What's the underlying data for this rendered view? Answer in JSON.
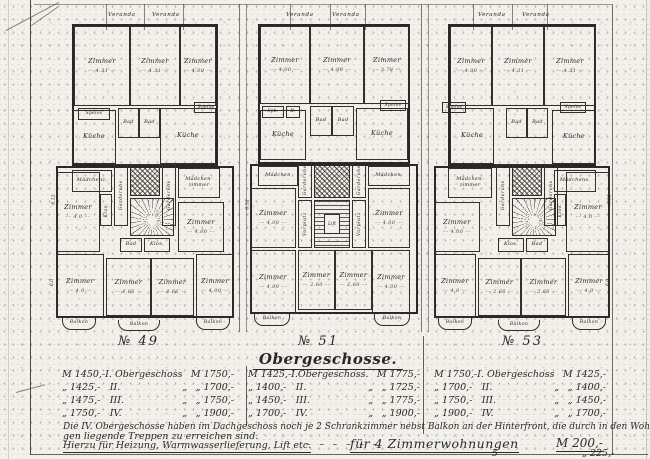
{
  "sheet": {
    "paper_color": "#f1f0ea",
    "ink_color": "#2b2925"
  },
  "title_block": {
    "heading": "Obergeschosse.",
    "price_tables": [
      {
        "building": "№ 49",
        "rows": [
          [
            "M 1450,-",
            "I. Obergeschoss",
            "",
            "M 1750,-"
          ],
          [
            "„ 1425,-",
            "II.",
            "„",
            "„ 1700,-"
          ],
          [
            "„ 1475,-",
            "III.",
            "„",
            "„ 1750,-"
          ],
          [
            "„ 1750,-",
            "IV.",
            "„",
            "„ 1900,-"
          ]
        ]
      },
      {
        "building": "№ 51",
        "rows": [
          [
            "M 1425,-",
            "I.Obergeschoss.",
            "",
            "M 1775,-"
          ],
          [
            "„ 1400,-",
            "II.",
            "„",
            "„ 1725,-"
          ],
          [
            "„ 1450,-",
            "III.",
            "„",
            "„ 1775,-"
          ],
          [
            "„ 1700,-",
            "IV.",
            "„",
            "„ 1900,-"
          ]
        ]
      },
      {
        "building": "№ 53",
        "rows": [
          [
            "M 1750,-",
            "I. Obergeschoss",
            "",
            "M 1425,-"
          ],
          [
            "„ 1700,-",
            "II.",
            "„",
            "„ 1400,-"
          ],
          [
            "„ 1750,-",
            "III.",
            "„",
            "„ 1450,-"
          ],
          [
            "„ 1900,-",
            "IV.",
            "„",
            "„ 1700,-"
          ]
        ]
      }
    ],
    "footnote_line1": "Die IV. Obergeschosse haben im Dachgeschoss noch je 2 Schrankzimmer nebst Balkon an der Hinterfront, die durch in den Wohnun=",
    "footnote_line2": "gen liegende Treppen zu erreichen sind.",
    "services_line": "Hierzu für Heizung, Warmwasserlieferung, Lift etc.",
    "services_dashes": "– – – – – –",
    "services_for4": "für 4 Zimmerwohnungen",
    "services_price4": "M 200,-",
    "services_for5": "5",
    "services_price5": "„ 225,-"
  },
  "buildings": [
    {
      "number": "№ 49",
      "x": 56,
      "y": 12,
      "w": 178,
      "h": 322,
      "num_x": 118,
      "num_y": 334,
      "veranda": [
        {
          "x": 52,
          "label": "Veranda"
        },
        {
          "x": 96,
          "label": "Veranda"
        }
      ],
      "blocks": [
        {
          "x": 16,
          "y": 12,
          "w": 146,
          "h": 142
        },
        {
          "x": 0,
          "y": 154,
          "w": 178,
          "h": 152
        }
      ],
      "rooms": [
        {
          "x": 18,
          "y": 14,
          "w": 56,
          "h": 80,
          "label": "Zimmer",
          "dim": "4.31"
        },
        {
          "x": 74,
          "y": 14,
          "w": 50,
          "h": 80,
          "label": "Zimmer",
          "dim": "4.31"
        },
        {
          "x": 124,
          "y": 14,
          "w": 36,
          "h": 80,
          "label": "Zimmer",
          "dim": "4.00"
        },
        {
          "x": 22,
          "y": 96,
          "w": 32,
          "h": 12,
          "label": "Speise",
          "fs": 4.5
        },
        {
          "x": 16,
          "y": 98,
          "w": 44,
          "h": 54,
          "label": "Küche"
        },
        {
          "x": 62,
          "y": 96,
          "w": 21,
          "h": 30,
          "label": "Bad",
          "fs": 5
        },
        {
          "x": 83,
          "y": 96,
          "w": 21,
          "h": 30,
          "label": "Bad",
          "fs": 5
        },
        {
          "x": 104,
          "y": 96,
          "w": 56,
          "h": 56,
          "label": "Küche"
        },
        {
          "x": 138,
          "y": 90,
          "w": 24,
          "h": 11,
          "label": "Speise",
          "fs": 4.5
        },
        {
          "x": 16,
          "y": 158,
          "w": 40,
          "h": 22,
          "label": "Mädchenz.",
          "fs": 5
        },
        {
          "x": 122,
          "y": 156,
          "w": 42,
          "h": 30,
          "label": "Mädchen-",
          "label2": "zimmer",
          "fs": 5
        },
        {
          "x": 0,
          "y": 160,
          "w": 44,
          "h": 80,
          "label": "Zimmer",
          "dim": "4.0"
        },
        {
          "x": 122,
          "y": 190,
          "w": 46,
          "h": 50,
          "label": "Zimmer",
          "dim": "4.00"
        },
        {
          "x": 64,
          "y": 226,
          "w": 22,
          "h": 14,
          "label": "Bad",
          "fs": 5
        },
        {
          "x": 88,
          "y": 226,
          "w": 26,
          "h": 14,
          "label": "Klos.",
          "fs": 5
        },
        {
          "x": 0,
          "y": 242,
          "w": 48,
          "h": 64,
          "label": "Zimmer",
          "dim": "4.0"
        },
        {
          "x": 50,
          "y": 246,
          "w": 45,
          "h": 58,
          "label": "Zimmer",
          "dim": "4.66"
        },
        {
          "x": 95,
          "y": 246,
          "w": 43,
          "h": 58,
          "label": "Zimmer",
          "dim": "4.66"
        },
        {
          "x": 140,
          "y": 242,
          "w": 38,
          "h": 64,
          "label": "Zimmer",
          "dim": "4.00"
        }
      ],
      "vrooms": [
        {
          "x": 58,
          "y": 152,
          "w": 14,
          "h": 62,
          "label": "Garderobe"
        },
        {
          "x": 106,
          "y": 152,
          "w": 14,
          "h": 62,
          "label": "Garderobe"
        },
        {
          "x": 44,
          "y": 182,
          "w": 12,
          "h": 32,
          "label": "Klos."
        }
      ],
      "shaft": {
        "x": 74,
        "y": 152,
        "w": 30,
        "h": 32
      },
      "stair": {
        "type": "spiral",
        "x": 74,
        "y": 186,
        "w": 44,
        "h": 38
      },
      "balconies": [
        {
          "x": 6,
          "y": 306,
          "w": 34,
          "h": 12,
          "label": "Balkon"
        },
        {
          "x": 62,
          "y": 308,
          "w": 42,
          "h": 11,
          "label": "Balkon"
        },
        {
          "x": 140,
          "y": 306,
          "w": 34,
          "h": 12,
          "label": "Balkon"
        }
      ],
      "sidedims": [
        {
          "x": -7,
          "y": 185,
          "label": "6.12"
        },
        {
          "x": -7,
          "y": 268,
          "label": "6.0"
        }
      ]
    },
    {
      "number": "№ 51",
      "x": 250,
      "y": 12,
      "w": 168,
      "h": 322,
      "num_x": 298,
      "num_y": 334,
      "veranda": [
        {
          "x": 36,
          "label": "Veranda"
        },
        {
          "x": 82,
          "label": "Veranda"
        }
      ],
      "blocks": [
        {
          "x": 8,
          "y": 12,
          "w": 152,
          "h": 140
        },
        {
          "x": 0,
          "y": 152,
          "w": 168,
          "h": 150
        }
      ],
      "rooms": [
        {
          "x": 10,
          "y": 14,
          "w": 50,
          "h": 78,
          "label": "Zimmer",
          "dim": "4.00"
        },
        {
          "x": 60,
          "y": 14,
          "w": 54,
          "h": 78,
          "label": "Zimmer",
          "dim": "4.00"
        },
        {
          "x": 114,
          "y": 14,
          "w": 46,
          "h": 78,
          "label": "Zimmer",
          "dim": "3.78"
        },
        {
          "x": 12,
          "y": 94,
          "w": 22,
          "h": 12,
          "label": "Spk.",
          "fs": 4.5
        },
        {
          "x": 36,
          "y": 94,
          "w": 14,
          "h": 12,
          "label": "B.",
          "fs": 4.5
        },
        {
          "x": 10,
          "y": 98,
          "w": 46,
          "h": 50,
          "label": "Küche"
        },
        {
          "x": 60,
          "y": 94,
          "w": 22,
          "h": 30,
          "label": "Bad",
          "fs": 5
        },
        {
          "x": 82,
          "y": 94,
          "w": 22,
          "h": 30,
          "label": "Bad",
          "fs": 5
        },
        {
          "x": 106,
          "y": 96,
          "w": 52,
          "h": 52,
          "label": "Küche"
        },
        {
          "x": 130,
          "y": 88,
          "w": 26,
          "h": 11,
          "label": "Speise",
          "fs": 4.5
        },
        {
          "x": 8,
          "y": 154,
          "w": 40,
          "h": 20,
          "label": "Mädchen",
          "fs": 5
        },
        {
          "x": 118,
          "y": 154,
          "w": 42,
          "h": 20,
          "label": "Mädchen.",
          "fs": 5
        },
        {
          "x": 0,
          "y": 176,
          "w": 46,
          "h": 60,
          "label": "Zimmer",
          "dim": "4.00"
        },
        {
          "x": 118,
          "y": 176,
          "w": 42,
          "h": 60,
          "label": "Zimmer",
          "dim": "4.00"
        },
        {
          "x": 48,
          "y": 238,
          "w": 37,
          "h": 60,
          "label": "Zimmer",
          "dim": "2.60"
        },
        {
          "x": 85,
          "y": 238,
          "w": 37,
          "h": 60,
          "label": "Zimmer",
          "dim": "2.60"
        },
        {
          "x": 0,
          "y": 238,
          "w": 46,
          "h": 64,
          "label": "Zimmer",
          "dim": "4.00"
        },
        {
          "x": 122,
          "y": 238,
          "w": 38,
          "h": 64,
          "label": "Zimmer",
          "dim": "4.00"
        }
      ],
      "vrooms": [
        {
          "x": 48,
          "y": 150,
          "w": 14,
          "h": 36,
          "label": "Garderobe"
        },
        {
          "x": 102,
          "y": 150,
          "w": 14,
          "h": 36,
          "label": "Garderobe"
        },
        {
          "x": 48,
          "y": 188,
          "w": 14,
          "h": 48,
          "label": "Vorplatz"
        },
        {
          "x": 102,
          "y": 188,
          "w": 14,
          "h": 48,
          "label": "Vorplatz"
        }
      ],
      "shaft": {
        "x": 64,
        "y": 150,
        "w": 36,
        "h": 36
      },
      "stair": {
        "type": "straight",
        "x": 64,
        "y": 188,
        "w": 36,
        "h": 48,
        "lift": "Lift"
      },
      "balconies": [
        {
          "x": 4,
          "y": 302,
          "w": 36,
          "h": 12,
          "label": "Balkon"
        },
        {
          "x": 124,
          "y": 302,
          "w": 36,
          "h": 12,
          "label": "Balkon"
        }
      ],
      "sidedims": [
        {
          "x": -7,
          "y": 190,
          "label": "6.12"
        }
      ]
    },
    {
      "number": "№ 53",
      "x": 434,
      "y": 12,
      "w": 176,
      "h": 322,
      "num_x": 502,
      "num_y": 334,
      "veranda": [
        {
          "x": 44,
          "label": "Veranda"
        },
        {
          "x": 88,
          "label": "Veranda"
        }
      ],
      "blocks": [
        {
          "x": 14,
          "y": 12,
          "w": 148,
          "h": 142
        },
        {
          "x": 0,
          "y": 154,
          "w": 176,
          "h": 152
        }
      ],
      "rooms": [
        {
          "x": 16,
          "y": 14,
          "w": 42,
          "h": 80,
          "label": "Zimmer",
          "dim": "4.00"
        },
        {
          "x": 58,
          "y": 14,
          "w": 52,
          "h": 80,
          "label": "Zimmer",
          "dim": "4.31"
        },
        {
          "x": 110,
          "y": 14,
          "w": 52,
          "h": 80,
          "label": "Zimmer",
          "dim": "4.31"
        },
        {
          "x": 8,
          "y": 90,
          "w": 24,
          "h": 11,
          "label": "Speise",
          "fs": 4.5
        },
        {
          "x": 16,
          "y": 96,
          "w": 44,
          "h": 56,
          "label": "Küche"
        },
        {
          "x": 72,
          "y": 96,
          "w": 21,
          "h": 30,
          "label": "Bad",
          "fs": 5
        },
        {
          "x": 93,
          "y": 96,
          "w": 21,
          "h": 30,
          "label": "Bad",
          "fs": 5
        },
        {
          "x": 118,
          "y": 98,
          "w": 44,
          "h": 54,
          "label": "Küche"
        },
        {
          "x": 126,
          "y": 90,
          "w": 26,
          "h": 11,
          "label": "Speise",
          "fs": 4.5
        },
        {
          "x": 14,
          "y": 156,
          "w": 44,
          "h": 30,
          "label": "Mädchen-",
          "label2": "zimmer",
          "fs": 5
        },
        {
          "x": 120,
          "y": 158,
          "w": 42,
          "h": 22,
          "label": "Mädchens.",
          "fs": 5
        },
        {
          "x": 0,
          "y": 190,
          "w": 46,
          "h": 50,
          "label": "Zimmer",
          "dim": "4.00"
        },
        {
          "x": 132,
          "y": 160,
          "w": 44,
          "h": 80,
          "label": "Zimmer",
          "dim": "4.0"
        },
        {
          "x": 64,
          "y": 226,
          "w": 26,
          "h": 14,
          "label": "Klos.",
          "fs": 5
        },
        {
          "x": 92,
          "y": 226,
          "w": 22,
          "h": 14,
          "label": "Bad",
          "fs": 5
        },
        {
          "x": 0,
          "y": 242,
          "w": 42,
          "h": 64,
          "label": "Zimmer",
          "dim": "4.0"
        },
        {
          "x": 44,
          "y": 246,
          "w": 43,
          "h": 58,
          "label": "Zimmer",
          "dim": "2.66"
        },
        {
          "x": 87,
          "y": 246,
          "w": 45,
          "h": 58,
          "label": "Zimmer",
          "dim": "2.66"
        },
        {
          "x": 134,
          "y": 242,
          "w": 42,
          "h": 64,
          "label": "Zimmer",
          "dim": "4.0"
        }
      ],
      "vrooms": [
        {
          "x": 62,
          "y": 152,
          "w": 14,
          "h": 62,
          "label": "Garderobe"
        },
        {
          "x": 110,
          "y": 152,
          "w": 14,
          "h": 62,
          "label": "Garderobe"
        },
        {
          "x": 120,
          "y": 182,
          "w": 12,
          "h": 32,
          "label": "Klos."
        }
      ],
      "shaft": {
        "x": 78,
        "y": 152,
        "w": 30,
        "h": 32
      },
      "stair": {
        "type": "spiral",
        "x": 78,
        "y": 186,
        "w": 44,
        "h": 38
      },
      "balconies": [
        {
          "x": 4,
          "y": 306,
          "w": 34,
          "h": 12,
          "label": "Balkon"
        },
        {
          "x": 64,
          "y": 308,
          "w": 42,
          "h": 11,
          "label": "Balkon"
        },
        {
          "x": 138,
          "y": 306,
          "w": 34,
          "h": 12,
          "label": "Balkon"
        }
      ],
      "sidedims": [
        {
          "x": 171,
          "y": 185,
          "label": "6.12"
        },
        {
          "x": 171,
          "y": 268,
          "label": "6.0"
        }
      ]
    }
  ]
}
